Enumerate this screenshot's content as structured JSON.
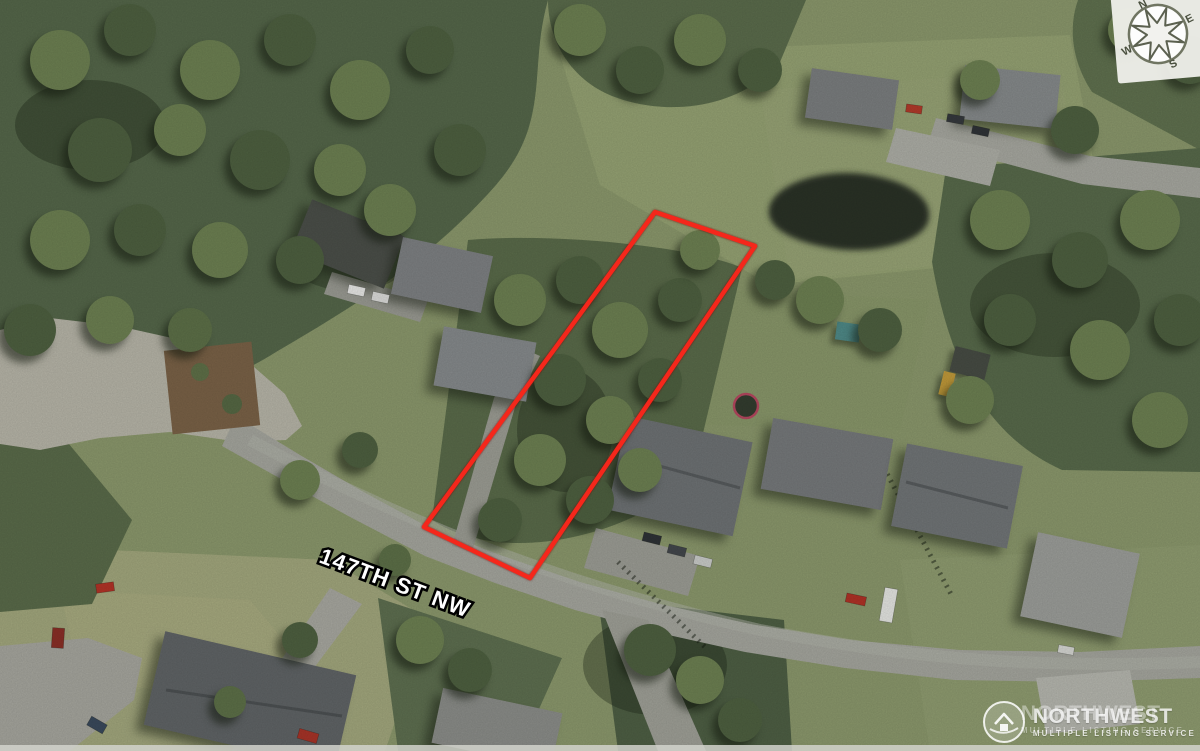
{
  "annotations": {
    "street_label": "147TH ST NW",
    "parcel_outline": {
      "points": "655,212 755,246 530,578 424,527",
      "color": "#f5271b"
    }
  },
  "compass": {
    "north": "N",
    "east": "E",
    "south": "S",
    "west": "W"
  },
  "watermark": {
    "brand": "NORTHWEST",
    "tagline": "MULTIPLE LISTING SERVICE"
  }
}
